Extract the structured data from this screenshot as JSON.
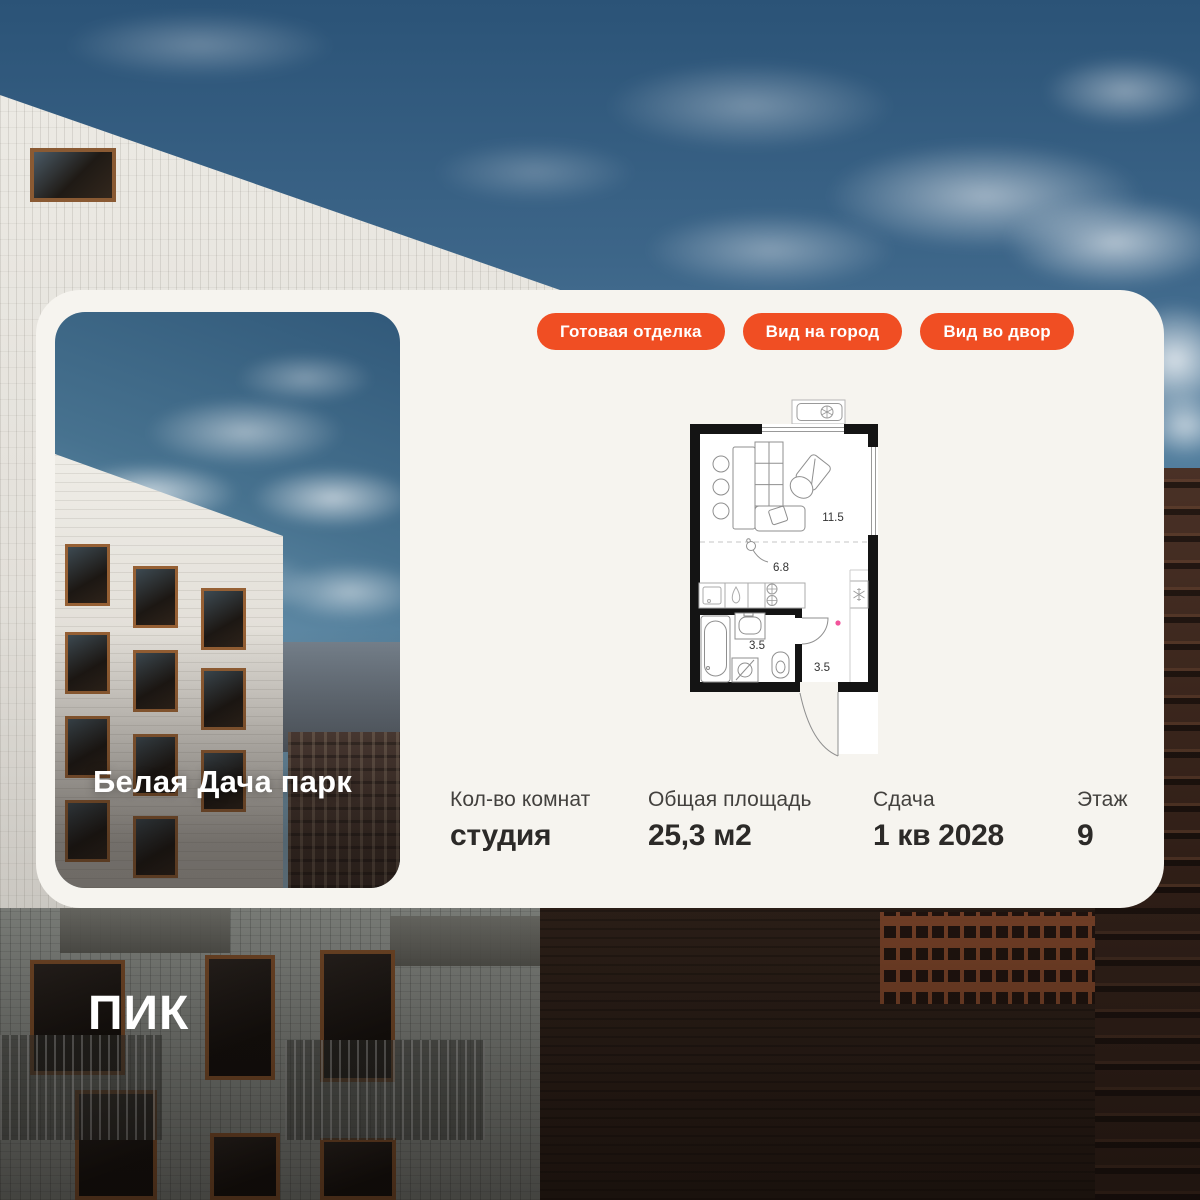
{
  "brand": {
    "logo_text": "ПИК"
  },
  "card": {
    "photo": {
      "project_name": "Белая Дача парк"
    },
    "tags": [
      {
        "label": "Готовая отделка"
      },
      {
        "label": "Вид на город"
      },
      {
        "label": "Вид во двор"
      }
    ],
    "floorplan": {
      "rooms": [
        {
          "name": "living-room",
          "area": "11.5"
        },
        {
          "name": "kitchen",
          "area": "6.8"
        },
        {
          "name": "bathroom",
          "area": "3.5"
        },
        {
          "name": "hallway",
          "area": "3.5"
        }
      ]
    },
    "stats": [
      {
        "label": "Кол-во комнат",
        "value": "студия"
      },
      {
        "label": "Общая площадь",
        "value": "25,3 м2"
      },
      {
        "label": "Сдача",
        "value": "1 кв 2028"
      },
      {
        "label": "Этаж",
        "value": "9"
      }
    ]
  },
  "colors": {
    "accent_orange": "#F04E23",
    "card_background": "#F6F4EF",
    "text_dark": "#2C2A28",
    "plan_walls": "#141414",
    "plan_marker_pink": "#F2549B"
  }
}
